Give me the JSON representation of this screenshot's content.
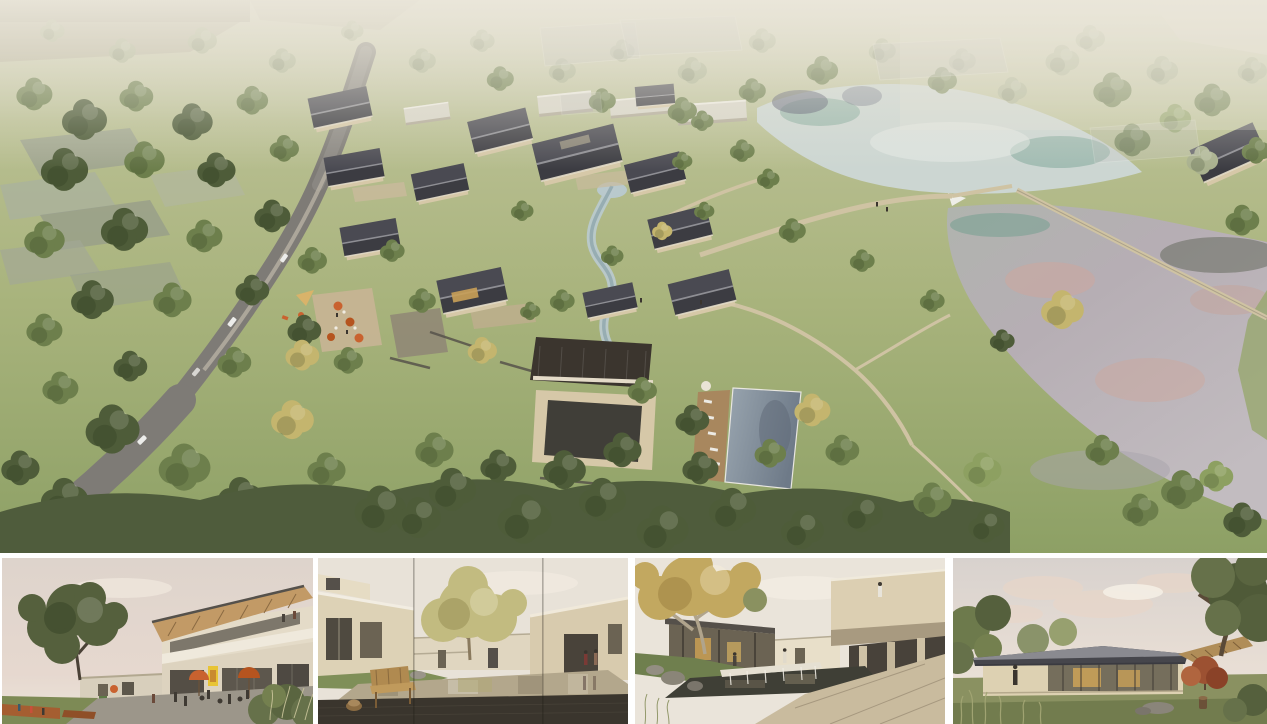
{
  "board": {
    "type": "architectural-rendering-board",
    "visible_text": [],
    "panels": [
      {
        "id": "aerial-masterplan",
        "depicts": "aerial view of hillside village resort with gabled houses, winding road, meadow paths, two lakes"
      },
      {
        "id": "street-plaza-view",
        "depicts": "eye-level plaza with large tree, two-story timber-roof building, umbrellas and people"
      },
      {
        "id": "courtyard-pond-view",
        "depicts": "courtyard reflecting pond with wooden bench, beige modern houses, yellow tree"
      },
      {
        "id": "waterfall-court-view",
        "depicts": "court with stone weir waterfall, autumn plane tree, cantilevered beige volume"
      },
      {
        "id": "pavilion-view",
        "depicts": "single-story glass pavilion with dark roof, lawn, red maple and large trees"
      }
    ]
  },
  "palette": {
    "board_bg": "#ffffff",
    "grass_light": "#c8cba4",
    "grass_mid": "#a8b37c",
    "grass_dark": "#8da065",
    "tree_dark": "#4e5c39",
    "tree_mid": "#6d7f4c",
    "tree_light": "#8da061",
    "tree_pale": "#a9b18e",
    "tree_yellow": "#c4b56e",
    "tree_red": "#9c5132",
    "roof_dark": "#3c3c42",
    "roof_brown": "#3b352e",
    "roof_light": "#d9d6c9",
    "wall_beige": "#d6c8a8",
    "wall_cream": "#e4dbc8",
    "stone": "#8c8172",
    "stone_dark": "#4a4741",
    "road_gray": "#7e7b76",
    "path_tan": "#cfc3a3",
    "water_pale": "#ccd6d2",
    "water_teal": "#6f9e8e",
    "water_reflect_dark": "#4a4f66",
    "lake_pink": "#cfa69b",
    "lake_lavender": "#b6aeb4",
    "pool_blue": "#8795a3",
    "deck_wood": "#a8875e",
    "accent_orange": "#c9622f",
    "sign_yellow": "#e8c435",
    "sky_pink": "#e6d8cf",
    "haze": "#ebe7db"
  }
}
